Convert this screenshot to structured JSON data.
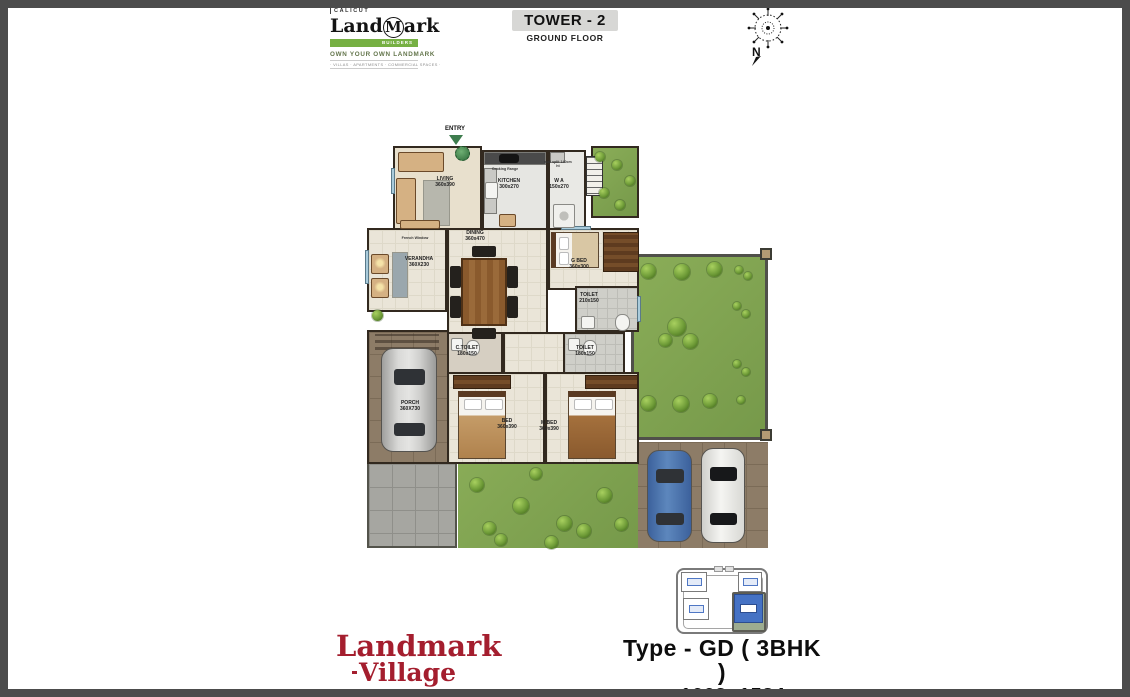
{
  "header": {
    "logo": {
      "city": "CALICUT",
      "brand_pre": "Land",
      "brand_circle": "M",
      "brand_post": "ark",
      "builders": "BUILDERS",
      "tagline": "OWN YOUR OWN LANDMARK",
      "categories": "· VILLAS · APARTMENTS · COMMERCIAL SPACES ·"
    },
    "tower_title": "TOWER - 2",
    "floor_subtitle": "GROUND FLOOR",
    "compass_north": "N"
  },
  "plan": {
    "entry": "ENTRY",
    "rooms": {
      "living": {
        "name": "LIVING",
        "dim": "360x390"
      },
      "kitchen": {
        "name": "KITCHEN",
        "dim": "300x270"
      },
      "work_area": {
        "name": "W A",
        "dim": "150x270"
      },
      "dining": {
        "name": "DINING",
        "dim": "360x470"
      },
      "verandah": {
        "name": "VERANDHA",
        "dim": "360X230"
      },
      "guest_bed": {
        "name": "G BED",
        "dim": "360x300"
      },
      "toilet_guest": {
        "name": "TOILET",
        "dim": "210x150"
      },
      "common_toilet": {
        "name": "C.TOILET",
        "dim": "180x150"
      },
      "toilet_master": {
        "name": "TOILET",
        "dim": "180x150"
      },
      "bed": {
        "name": "BED",
        "dim": "360x390"
      },
      "master_bed": {
        "name": "M BED",
        "dim": "360x390"
      },
      "porch": {
        "name": "PORCH",
        "dim": "360X730"
      }
    },
    "annotations": {
      "cooking_range": "Cooking Range",
      "wall_split": "wall split 140cm ht",
      "french_window": "French Window"
    }
  },
  "footer": {
    "brand_line1": "Landmark",
    "brand_line2": "Village",
    "type_label": "Type - GD ( 3BHK )",
    "area_label": "Area -",
    "area_value": "1663+1584",
    "area_unit": "sqft",
    "note": "All Dimensions Are In CM"
  },
  "colors": {
    "logo_green": "#76b043",
    "brand_red": "#a41e2e",
    "keyplan_unit_blue": "#4572c4",
    "title_box_gray": "#d7d7d5",
    "lawn_green": "#80a351"
  }
}
